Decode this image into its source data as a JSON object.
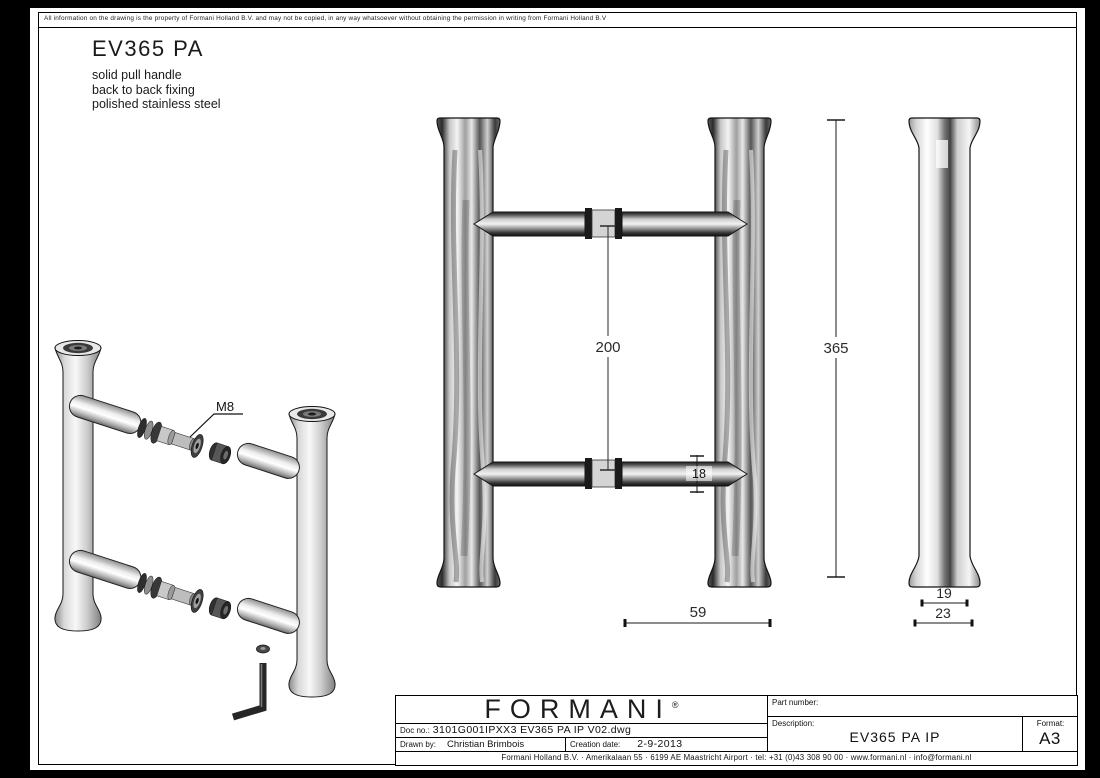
{
  "colors": {
    "paper": "#ffffff",
    "ink": "#000000",
    "steel_light": "#f2f2f2",
    "steel_dark": "#2a2a2a"
  },
  "disclaimer": "All information on the drawing is the property of Formani Holland B.V. and may not be copied, in any way whatsoever without obtaining the permission in writing from Formani Holland B.V",
  "header": {
    "product_code": "EV365 PA",
    "description_lines": [
      "solid pull handle",
      "back to back fixing",
      "polished stainless steel"
    ]
  },
  "drawing": {
    "dim_bar_spacing": "200",
    "dim_total_height": "365",
    "dim_bar_diameter": "18",
    "dim_projection": "59",
    "dim_tube_diameter": "19",
    "dim_flare_diameter": "23",
    "bolt_label": "M8"
  },
  "title_block": {
    "logo_text": "FORMANI",
    "logo_reg_mark": "®",
    "doc_no_label": "Doc no.:",
    "doc_no_value": "3101G001IPXX3 EV365 PA IP V02.dwg",
    "drawn_by_label": "Drawn by:",
    "drawn_by_value": "Christian Brimbois",
    "creation_date_label": "Creation date:",
    "creation_date_value": "2-9-2013",
    "part_number_label": "Part number:",
    "part_number_value": "",
    "description_label": "Description:",
    "description_value": "EV365 PA IP",
    "format_label": "Format:",
    "format_value": "A3",
    "address": "Formani Holland B.V. · Amerikalaan 55 · 6199 AE Maastricht Airport · tel: +31 (0)43 308 90 00 · www.formani.nl · info@formani.nl"
  }
}
